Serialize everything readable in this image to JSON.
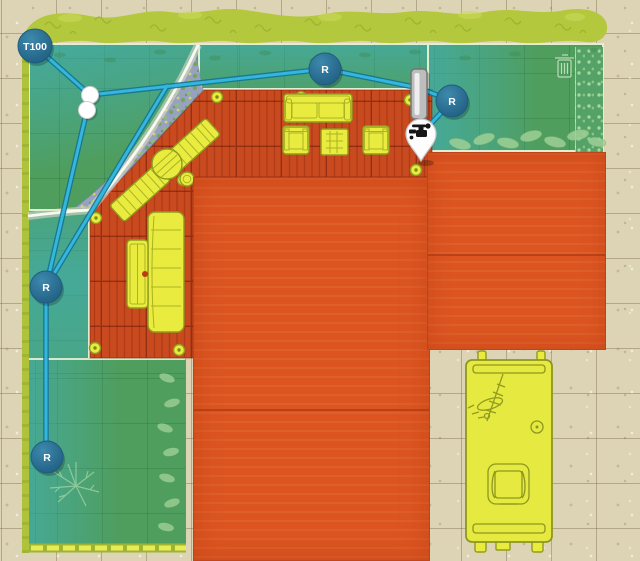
{
  "app": {
    "name": "garden-irrigation-planner",
    "view": "plan-canvas"
  },
  "devices": {
    "controller": {
      "label": "T100",
      "type": "water-controller"
    },
    "sprinklers": [
      {
        "label": "R",
        "position": "top-center"
      },
      {
        "label": "R",
        "position": "top-right"
      },
      {
        "label": "R",
        "position": "mid-left"
      },
      {
        "label": "R",
        "position": "bottom-left"
      }
    ],
    "tap": {
      "icon": "faucet-icon",
      "type": "water-source-pin"
    },
    "gate": {
      "type": "wall-passage"
    },
    "junction_count": 2
  },
  "zones": {
    "lawn_zone_count": 5,
    "coverage_color": "#3eb2c8"
  },
  "palette": {
    "tile": "#ddd4b6",
    "lawn": "#4f9e5e",
    "hedge": "#b4c83d",
    "deck": "#c84a1e",
    "roof": "#dc5521",
    "pipe": "#35b6dc",
    "pipe_edge": "#157394",
    "node": "#25678c",
    "furniture": "#e9eb3f",
    "vehicle": "#e6e93f"
  },
  "objects": {
    "vehicle": "caravan-top-view",
    "furniture": [
      "sofa",
      "armchair",
      "coffee-table",
      "armchair",
      "sun-lounger",
      "sun-lounger",
      "round-table",
      "stool",
      "dining-table",
      "bench"
    ]
  }
}
